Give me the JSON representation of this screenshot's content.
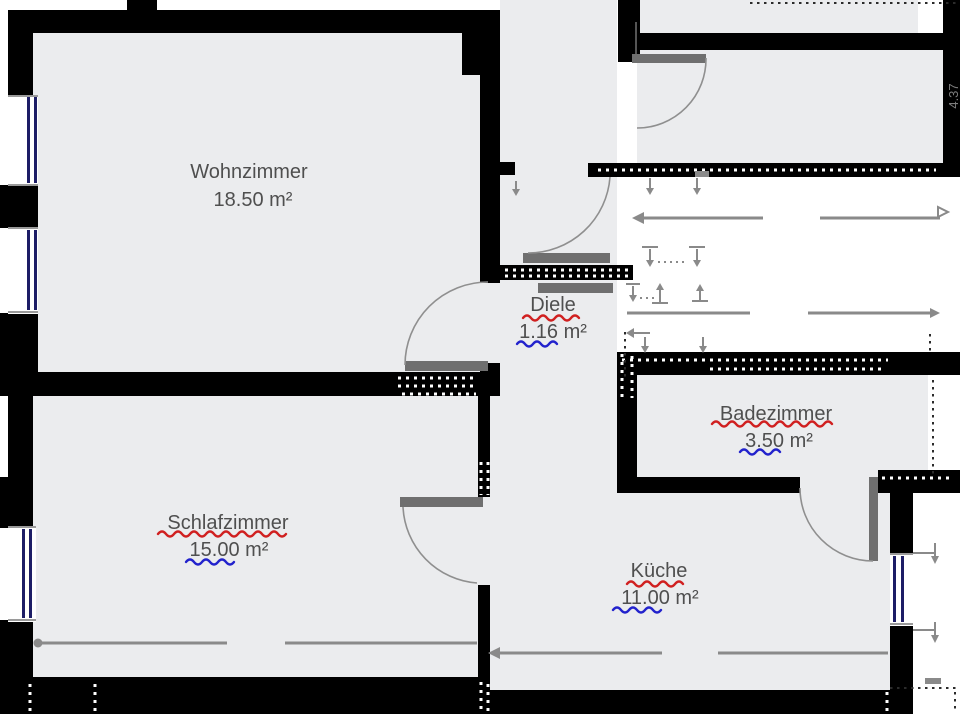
{
  "floorplan": {
    "rooms": [
      {
        "id": "wohnzimmer",
        "name": "Wohnzimmer",
        "area": "18.50 m²",
        "name_spell_underline": false,
        "area_number_underline": false
      },
      {
        "id": "diele",
        "name": "Diele",
        "area": "1.16 m²",
        "name_spell_underline": true,
        "area_number_underline": true
      },
      {
        "id": "badezimmer",
        "name": "Badezimmer",
        "area": "3.50 m²",
        "name_spell_underline": true,
        "area_number_underline": true
      },
      {
        "id": "schlafzimmer",
        "name": "Schlafzimmer",
        "area": "15.00 m²",
        "name_spell_underline": true,
        "area_number_underline": true
      },
      {
        "id": "kueche",
        "name": "Küche",
        "area": "11.00 m²",
        "name_spell_underline": true,
        "area_number_underline": true
      }
    ],
    "dimension_labels": {
      "right_wall_length": "4.37"
    },
    "colors": {
      "background": "#ffffff",
      "wall": "#000000",
      "room_fill": "#ebecee",
      "door_leaf": "#6f6f6f",
      "door_swing": "#8f8f8f",
      "window_frame": "#1d1d66",
      "dimension": "#8a8a8a",
      "label_text": "#4f4f4f",
      "spelling_underline": "#d02020",
      "number_underline": "#2222cc"
    }
  }
}
